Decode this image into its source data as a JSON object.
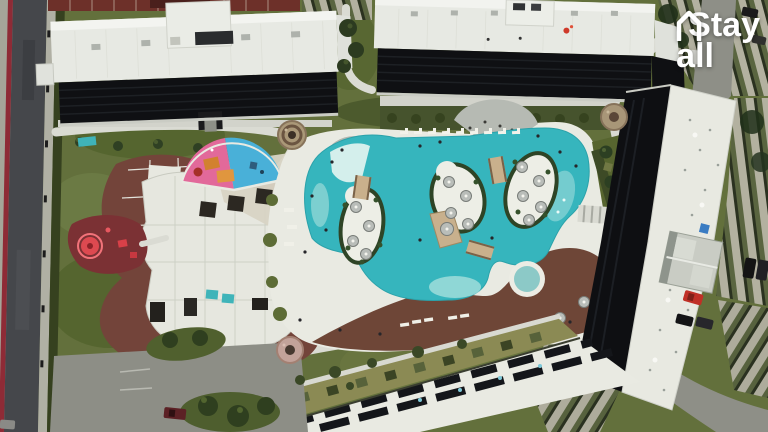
{
  "scene": {
    "type": "aerial-drone-photograph",
    "description": "Top-down drone view of a resort condominium: winding turquoise lagoon pool with islands, clubhouse with brown deck, playgrounds, white apartment blocks with shadowed facades, covered parking rows and a perimeter road",
    "watermark": {
      "line1": "Stay",
      "line2_suffix": "all",
      "icon": "house-outline-icon",
      "color": "#ffffff"
    }
  },
  "palette": {
    "grass": "#63703c",
    "grass_dark": "#4c5a2d",
    "pool_water": "#36b5bd",
    "pool_shallow": "#8fd6d4",
    "deck_white": "#e9eae2",
    "deck_brown": "#6e4637",
    "clubhouse_deck": "#73443a",
    "roof_white": "#e7e9e3",
    "facade_shadow": "#0f1013",
    "road_asphalt": "#45474b",
    "bike_lane_red": "#8e2b36",
    "plaza_tan": "#aa9878",
    "playground_pink": "#e2699a",
    "playground_blue": "#49b0d8",
    "playground_red": "#dd4950",
    "carport_stripe": "#5a6540",
    "car_red": "#c03026"
  }
}
